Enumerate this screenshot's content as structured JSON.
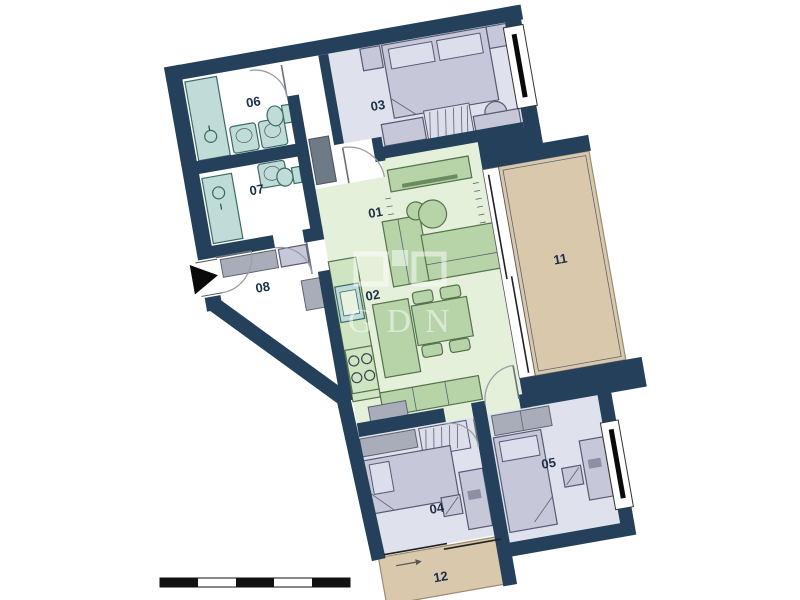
{
  "rooms": [
    {
      "label": "01"
    },
    {
      "label": "02"
    },
    {
      "label": "03"
    },
    {
      "label": "04"
    },
    {
      "label": "05"
    },
    {
      "label": "06"
    },
    {
      "label": "07"
    },
    {
      "label": "08"
    },
    {
      "label": "11"
    },
    {
      "label": "12"
    }
  ],
  "watermark": {
    "text": "GDN"
  },
  "scale_bar": {
    "segments": [
      "dark",
      "light",
      "dark",
      "light",
      "dark"
    ]
  },
  "colors": {
    "wall": "#24405a",
    "bedroomFloor": "#dfe1ec",
    "livingFloor": "#e5f0db",
    "bathFloor": "#ffffff",
    "terrace": "#d9c8ac",
    "terraceEdge": "#9b8c70",
    "furnGreen": "#b6d4a7",
    "furnGreenEdge": "#55714c",
    "counter": "#cfe4c0",
    "furnLav": "#c6c8da",
    "furnLavLight": "#dcdeeb",
    "furnLavEdge": "#585a74",
    "furnGray": "#a9adb9",
    "teal": "#c0dcd9",
    "tealEdge": "#3c6b66",
    "label": "#1b2f45",
    "arrow": "#0a0a0a"
  }
}
